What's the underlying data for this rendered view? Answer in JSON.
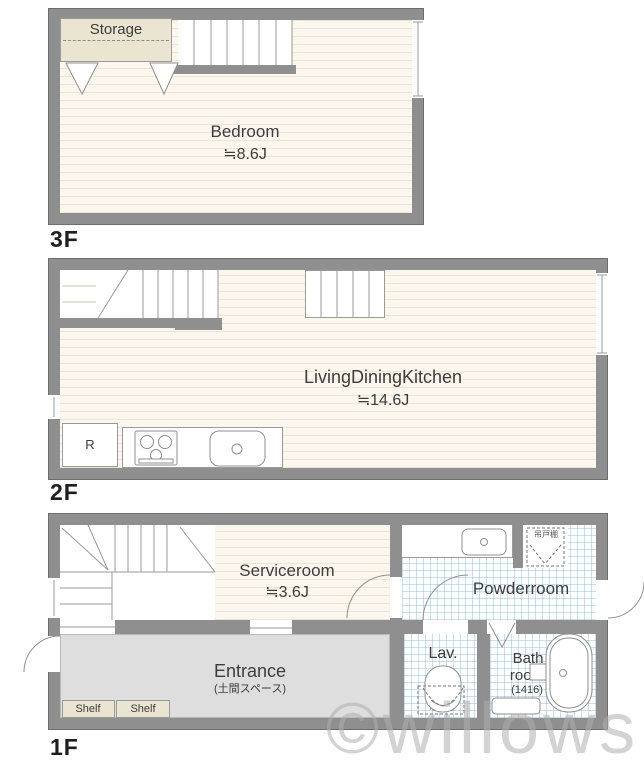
{
  "watermark": "©willows",
  "colors": {
    "wall": "#8f8f8f",
    "wall_outline": "#6d6d6d",
    "wood_floor": "#fbf7ee",
    "wood_stripe": "#d6ba8c",
    "tile_line": "#7dafd2",
    "entrance_floor": "#dedede",
    "cabinet_beige": "#e9e5d1",
    "text": "#3d3d3d",
    "watermark_gray": "#afafaf"
  },
  "floor3": {
    "label": "3F",
    "storage": "Storage",
    "bedroom": "Bedroom",
    "bedroom_size": "≒8.6J"
  },
  "floor2": {
    "label": "2F",
    "ldk": "LivingDiningKitchen",
    "ldk_size": "≒14.6J",
    "fridge": "R"
  },
  "floor1": {
    "label": "1F",
    "serviceroom": "Serviceroom",
    "serviceroom_size": "≒3.6J",
    "powderroom": "Powderroom",
    "lav": "Lav.",
    "bath_line1": "Bath",
    "bath_line2": "room",
    "bath_size": "(1416)",
    "entrance": "Entrance",
    "entrance_note": "(土間スペース)",
    "shelves": [
      "Shelf",
      "Shelf"
    ],
    "cupboard_powder": "吊戸棚",
    "cupboard_lav": "吊戸棚"
  }
}
